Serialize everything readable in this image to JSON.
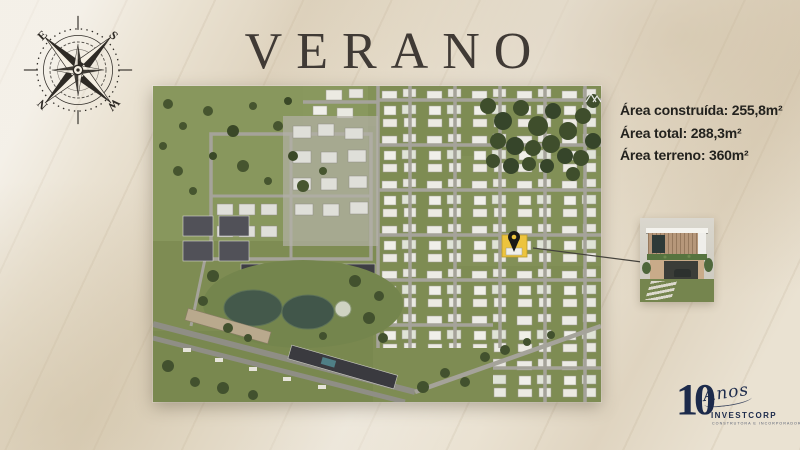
{
  "slide": {
    "title": "VERANO"
  },
  "compass": {
    "north_label": "N",
    "south_label": "S",
    "east_label": "E",
    "west_label": "W"
  },
  "property_details": {
    "lines": [
      "Área construída: 255,8m²",
      "Área total: 288,3m²",
      "Área terreno: 360m²"
    ]
  },
  "map": {
    "description": "aerial-master-plan-render",
    "highlight_lot_color": "#edc43d",
    "pin_color": "#1a1a18"
  },
  "logo": {
    "years_number": "10",
    "years_word": "Anos",
    "company": "INVESTCORP",
    "tagline": "CONSTRUTORA E INCORPORADORA",
    "color": "#1c2a4b"
  },
  "colors": {
    "background": "#eae2d2",
    "title_text": "#403a35",
    "details_text": "#23221e",
    "map_green": "#7e8c53",
    "lake": "#44594b",
    "road": "#a5a39a"
  }
}
